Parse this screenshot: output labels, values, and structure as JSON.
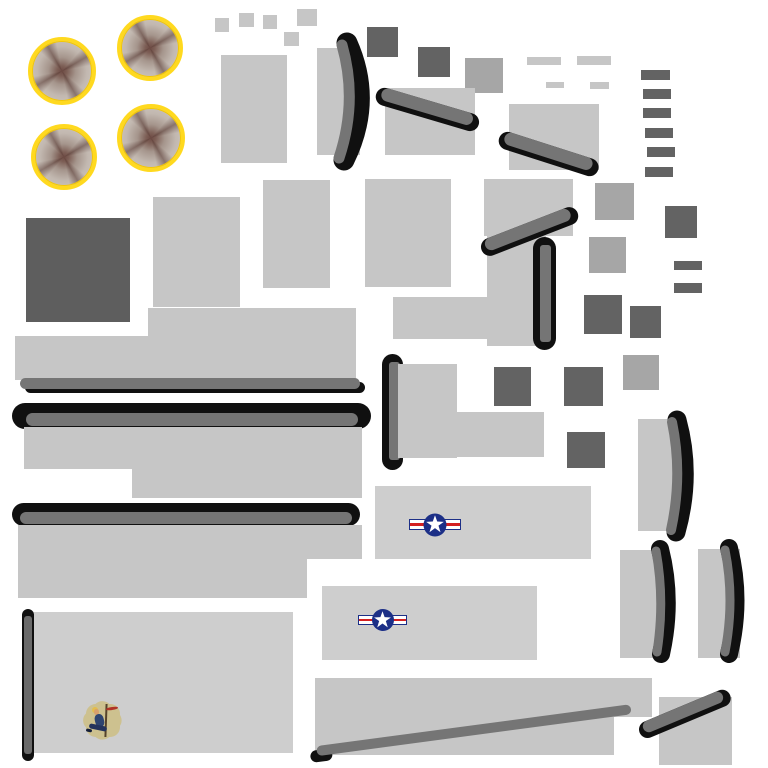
{
  "meta": {
    "canvas": {
      "width": 768,
      "height": 768,
      "background": "#ffffff"
    }
  },
  "palette": {
    "white": "#ffffff",
    "light": "#c6c6c6",
    "light2": "#cecece",
    "mid": "#a6a6a6",
    "dark": "#636363",
    "dark2": "#5e5e5e",
    "gray": "#757575",
    "gray2": "#6a6a6a",
    "black": "#101010",
    "yellow": "#ffd91f",
    "navy": "#1c2f87",
    "red": "#d42020",
    "tan": "#cdc18f",
    "blue": "#2e4470",
    "skin": "#d8a06c"
  },
  "decals": {
    "insignia": {
      "disc": "#1c2f87",
      "star": "#ffffff",
      "bar_fill": "#ffffff",
      "bar_border": "#1c2f87",
      "stripe": "#d42020"
    },
    "engine": {
      "ring": "#ffd91f",
      "disc": "#ccc4bd",
      "hub": "#6d4a43"
    },
    "noseart": {
      "background": "#cdc18f",
      "figure": "#2e4470",
      "skin": "#d8a06c",
      "hair": "#e3bd4e",
      "script": "#b03226"
    }
  },
  "shapes": [
    {
      "n": "scrap-square-1",
      "t": "rect",
      "x": 215,
      "y": 18,
      "w": 14,
      "h": 14,
      "c": "light"
    },
    {
      "n": "scrap-square-2",
      "t": "rect",
      "x": 239,
      "y": 13,
      "w": 15,
      "h": 14,
      "c": "light"
    },
    {
      "n": "scrap-square-3",
      "t": "rect",
      "x": 263,
      "y": 15,
      "w": 14,
      "h": 14,
      "c": "light"
    },
    {
      "n": "scrap-square-4",
      "t": "rect",
      "x": 297,
      "y": 9,
      "w": 20,
      "h": 17,
      "c": "light"
    },
    {
      "n": "scrap-square-5",
      "t": "rect",
      "x": 284,
      "y": 32,
      "w": 15,
      "h": 14,
      "c": "light"
    },
    {
      "n": "panel-rect-1",
      "t": "rect",
      "x": 221,
      "y": 55,
      "w": 66,
      "h": 108,
      "c": "light"
    },
    {
      "n": "prop-blade-1-backplate",
      "t": "rect",
      "x": 317,
      "y": 48,
      "w": 43,
      "h": 107,
      "c": "light"
    },
    {
      "n": "prop-blade-1",
      "t": "blade",
      "x": 315,
      "y": 31,
      "w": 56,
      "h": 141,
      "vb": "0 0 56 141",
      "black": "M32,12 Q58,70 29,129",
      "gray": "M27,14 Q43,70 24,127",
      "bw": 21,
      "gw": 11
    },
    {
      "n": "dark-square-1",
      "t": "rect",
      "x": 367,
      "y": 27,
      "w": 31,
      "h": 30,
      "c": "dark"
    },
    {
      "n": "dark-square-2",
      "t": "rect",
      "x": 418,
      "y": 47,
      "w": 32,
      "h": 30,
      "c": "dark"
    },
    {
      "n": "mid-square-1",
      "t": "rect",
      "x": 465,
      "y": 58,
      "w": 38,
      "h": 35,
      "c": "mid"
    },
    {
      "n": "window-dash-1",
      "t": "rect",
      "x": 527,
      "y": 57,
      "w": 34,
      "h": 8,
      "c": "light"
    },
    {
      "n": "window-dash-2",
      "t": "rect",
      "x": 577,
      "y": 56,
      "w": 34,
      "h": 9,
      "c": "light"
    },
    {
      "n": "window-dash-3",
      "t": "rect",
      "x": 546,
      "y": 82,
      "w": 18,
      "h": 6,
      "c": "light"
    },
    {
      "n": "window-dash-4",
      "t": "rect",
      "x": 590,
      "y": 82,
      "w": 19,
      "h": 7,
      "c": "light"
    },
    {
      "n": "ladder-bar-1",
      "t": "rect",
      "x": 641,
      "y": 70,
      "w": 29,
      "h": 10,
      "c": "dark"
    },
    {
      "n": "ladder-bar-2",
      "t": "rect",
      "x": 643,
      "y": 89,
      "w": 28,
      "h": 10,
      "c": "dark"
    },
    {
      "n": "ladder-bar-3",
      "t": "rect",
      "x": 643,
      "y": 108,
      "w": 28,
      "h": 10,
      "c": "dark"
    },
    {
      "n": "ladder-bar-4",
      "t": "rect",
      "x": 645,
      "y": 128,
      "w": 28,
      "h": 10,
      "c": "dark"
    },
    {
      "n": "ladder-bar-5",
      "t": "rect",
      "x": 647,
      "y": 147,
      "w": 28,
      "h": 10,
      "c": "dark"
    },
    {
      "n": "ladder-bar-6",
      "t": "rect",
      "x": 645,
      "y": 167,
      "w": 28,
      "h": 10,
      "c": "dark"
    },
    {
      "n": "panel-rect-2",
      "t": "rect",
      "x": 385,
      "y": 88,
      "w": 90,
      "h": 67,
      "c": "light"
    },
    {
      "n": "strut-diagonal-1",
      "t": "diag",
      "x": 382,
      "y": 95,
      "len": 95,
      "th": 13,
      "a": 16.5,
      "caps": "both"
    },
    {
      "n": "panel-rect-3",
      "t": "rect",
      "x": 509,
      "y": 104,
      "w": 90,
      "h": 66,
      "c": "light"
    },
    {
      "n": "strut-diagonal-2",
      "t": "diag",
      "x": 505,
      "y": 139,
      "len": 92,
      "th": 13,
      "a": 17.8,
      "caps": "both"
    },
    {
      "n": "dark-panel-large",
      "t": "rect",
      "x": 26,
      "y": 218,
      "w": 104,
      "h": 104,
      "c": "dark2"
    },
    {
      "n": "panel-rect-4",
      "t": "rect",
      "x": 153,
      "y": 197,
      "w": 87,
      "h": 110,
      "c": "light"
    },
    {
      "n": "panel-rect-5",
      "t": "rect",
      "x": 263,
      "y": 180,
      "w": 67,
      "h": 108,
      "c": "light"
    },
    {
      "n": "panel-rect-6",
      "t": "rect",
      "x": 365,
      "y": 179,
      "w": 86,
      "h": 108,
      "c": "light"
    },
    {
      "n": "panel-rect-7",
      "t": "rect",
      "x": 484,
      "y": 179,
      "w": 89,
      "h": 57,
      "c": "light"
    },
    {
      "n": "panel-rect-8",
      "t": "rect",
      "x": 487,
      "y": 236,
      "w": 59,
      "h": 110,
      "c": "light"
    },
    {
      "n": "panel-arm-1",
      "t": "rect",
      "x": 393,
      "y": 297,
      "w": 94,
      "h": 42,
      "c": "light"
    },
    {
      "n": "strut-diagonal-3",
      "t": "diag",
      "x": 487,
      "y": 247,
      "len": 91,
      "th": 13,
      "a": -21.2,
      "caps": "both"
    },
    {
      "n": "spar-pill-vertical-1",
      "t": "vpill",
      "x": 533,
      "y": 237,
      "w": 23,
      "h": 113,
      "ix": 7,
      "iy": 8,
      "iw": 11,
      "ih": 97,
      "ic": "gray"
    },
    {
      "n": "mid-square-2",
      "t": "rect",
      "x": 595,
      "y": 183,
      "w": 39,
      "h": 37,
      "c": "mid"
    },
    {
      "n": "mid-square-3",
      "t": "rect",
      "x": 589,
      "y": 237,
      "w": 37,
      "h": 36,
      "c": "mid"
    },
    {
      "n": "dark-square-3",
      "t": "rect",
      "x": 665,
      "y": 206,
      "w": 32,
      "h": 32,
      "c": "dark"
    },
    {
      "n": "dark-dash-1",
      "t": "rect",
      "x": 674,
      "y": 261,
      "w": 28,
      "h": 9,
      "c": "dark"
    },
    {
      "n": "dark-dash-2",
      "t": "rect",
      "x": 674,
      "y": 283,
      "w": 28,
      "h": 10,
      "c": "dark"
    },
    {
      "n": "dark-square-4",
      "t": "rect",
      "x": 584,
      "y": 295,
      "w": 38,
      "h": 39,
      "c": "dark"
    },
    {
      "n": "dark-square-5",
      "t": "rect",
      "x": 630,
      "y": 306,
      "w": 31,
      "h": 32,
      "c": "dark"
    },
    {
      "n": "mid-square-4",
      "t": "rect",
      "x": 623,
      "y": 355,
      "w": 36,
      "h": 35,
      "c": "mid"
    },
    {
      "n": "wing-band-upper",
      "t": "rect",
      "x": 148,
      "y": 308,
      "w": 208,
      "h": 30,
      "c": "light"
    },
    {
      "n": "wing-band-lower",
      "t": "rect",
      "x": 15,
      "y": 336,
      "w": 341,
      "h": 44,
      "c": "light"
    },
    {
      "n": "wing-edge-shadow",
      "t": "pill",
      "x": 25,
      "y": 382,
      "w": 340,
      "h": 11,
      "c": "black"
    },
    {
      "n": "wing-edge-strip",
      "t": "pill",
      "x": 20,
      "y": 378,
      "w": 340,
      "h": 11,
      "c": "gray"
    },
    {
      "n": "leading-edge-bar-1",
      "t": "pill",
      "x": 12,
      "y": 403,
      "w": 359,
      "h": 26,
      "c": "black"
    },
    {
      "n": "leading-edge-bar-1-core",
      "t": "pill",
      "x": 26,
      "y": 413,
      "w": 332,
      "h": 13,
      "c": "gray"
    },
    {
      "n": "wing-panel-1a",
      "t": "rect",
      "x": 24,
      "y": 427,
      "w": 338,
      "h": 42,
      "c": "light"
    },
    {
      "n": "wing-panel-1b",
      "t": "rect",
      "x": 132,
      "y": 469,
      "w": 230,
      "h": 29,
      "c": "light"
    },
    {
      "n": "leading-edge-bar-2",
      "t": "pill",
      "x": 12,
      "y": 503,
      "w": 348,
      "h": 23,
      "c": "black"
    },
    {
      "n": "leading-edge-bar-2-core",
      "t": "pill",
      "x": 20,
      "y": 512,
      "w": 332,
      "h": 12,
      "c": "gray"
    },
    {
      "n": "wing-panel-2a",
      "t": "rect",
      "x": 18,
      "y": 525,
      "w": 344,
      "h": 34,
      "c": "light"
    },
    {
      "n": "wing-panel-2b",
      "t": "rect",
      "x": 18,
      "y": 558,
      "w": 289,
      "h": 40,
      "c": "light"
    },
    {
      "n": "dark-square-6",
      "t": "rect",
      "x": 494,
      "y": 367,
      "w": 37,
      "h": 39,
      "c": "dark"
    },
    {
      "n": "dark-square-7",
      "t": "rect",
      "x": 564,
      "y": 367,
      "w": 39,
      "h": 39,
      "c": "dark"
    },
    {
      "n": "dark-square-8",
      "t": "rect",
      "x": 567,
      "y": 432,
      "w": 38,
      "h": 36,
      "c": "dark"
    },
    {
      "n": "spar-pill-vertical-2",
      "t": "vpill",
      "x": 382,
      "y": 354,
      "w": 21,
      "h": 116,
      "ix": 7,
      "iy": 8,
      "iw": 11,
      "ih": 98,
      "ic": "gray"
    },
    {
      "n": "tail-panel-a",
      "t": "rect",
      "x": 398,
      "y": 364,
      "w": 59,
      "h": 94,
      "c": "light"
    },
    {
      "n": "tail-panel-b",
      "t": "rect",
      "x": 457,
      "y": 412,
      "w": 87,
      "h": 45,
      "c": "light"
    },
    {
      "n": "fuselage-side-1",
      "t": "rect",
      "x": 375,
      "y": 486,
      "w": 216,
      "h": 73,
      "c": "light2"
    },
    {
      "n": "star-insignia-1",
      "t": "insignia",
      "x": 409,
      "y": 513,
      "w": 52,
      "h": 23
    },
    {
      "n": "fuselage-side-2",
      "t": "rect",
      "x": 322,
      "y": 586,
      "w": 215,
      "h": 74,
      "c": "light2"
    },
    {
      "n": "star-insignia-2",
      "t": "insignia",
      "x": 358,
      "y": 609,
      "w": 49,
      "h": 22
    },
    {
      "n": "nose-panel",
      "t": "rect",
      "x": 23,
      "y": 612,
      "w": 270,
      "h": 141,
      "c": "light2"
    },
    {
      "n": "nose-edge-pill",
      "t": "vpill",
      "x": 22,
      "y": 609,
      "w": 12,
      "h": 152,
      "ix": 2,
      "iy": 7,
      "iw": 8,
      "ih": 138,
      "ic": "gray2"
    },
    {
      "n": "nose-art-pinup",
      "t": "pinup",
      "x": 85,
      "y": 702,
      "w": 36,
      "h": 37
    },
    {
      "n": "belly-panel-a",
      "t": "rect",
      "x": 315,
      "y": 678,
      "w": 337,
      "h": 39,
      "c": "light"
    },
    {
      "n": "belly-panel-b",
      "t": "rect",
      "x": 315,
      "y": 717,
      "w": 299,
      "h": 38,
      "c": "light"
    },
    {
      "n": "belly-strut-diagonal",
      "t": "diag",
      "x": 318,
      "y": 753,
      "len": 317,
      "th": 10,
      "a": -7.6,
      "caps": "left"
    },
    {
      "n": "flap-panel",
      "t": "rect",
      "x": 659,
      "y": 697,
      "w": 73,
      "h": 68,
      "c": "light"
    },
    {
      "n": "flap-strut-diagonal",
      "t": "diag",
      "x": 645,
      "y": 730,
      "len": 86,
      "th": 12,
      "a": -22.7,
      "caps": "both"
    },
    {
      "n": "prop-blade-2-backplate",
      "t": "rect",
      "x": 638,
      "y": 419,
      "w": 45,
      "h": 112,
      "c": "light"
    },
    {
      "n": "prop-blade-2",
      "t": "blade",
      "x": 650,
      "y": 406,
      "w": 42,
      "h": 138,
      "vb": "0 0 42 138",
      "black": "M27,14 Q42,69 26,126",
      "gray": "M22,16 Q33,69 21,124",
      "bw": 19,
      "gw": 10
    },
    {
      "n": "prop-blade-3-backplate",
      "t": "rect",
      "x": 620,
      "y": 550,
      "w": 47,
      "h": 108,
      "c": "light"
    },
    {
      "n": "prop-blade-3",
      "t": "blade",
      "x": 641,
      "y": 536,
      "w": 38,
      "h": 130,
      "vb": "0 0 38 130",
      "black": "M19,13 Q32,64 20,118",
      "gray": "M15,15 Q24,64 16,116",
      "bw": 18,
      "gw": 9
    },
    {
      "n": "prop-blade-4-backplate",
      "t": "rect",
      "x": 698,
      "y": 549,
      "w": 42,
      "h": 109,
      "c": "light"
    },
    {
      "n": "prop-blade-4",
      "t": "blade",
      "x": 708,
      "y": 535,
      "w": 38,
      "h": 131,
      "vb": "0 0 38 131",
      "black": "M21,13 Q34,65 21,119",
      "gray": "M17,15 Q27,65 17,117",
      "bw": 18,
      "gw": 9
    },
    {
      "n": "engine-cowl-1",
      "t": "engine",
      "cx": 62,
      "cy": 71,
      "r": 34
    },
    {
      "n": "engine-cowl-2",
      "t": "engine",
      "cx": 150,
      "cy": 48,
      "r": 33
    },
    {
      "n": "engine-cowl-3",
      "t": "engine",
      "cx": 64,
      "cy": 157,
      "r": 33
    },
    {
      "n": "engine-cowl-4",
      "t": "engine",
      "cx": 151,
      "cy": 138,
      "r": 34
    }
  ]
}
